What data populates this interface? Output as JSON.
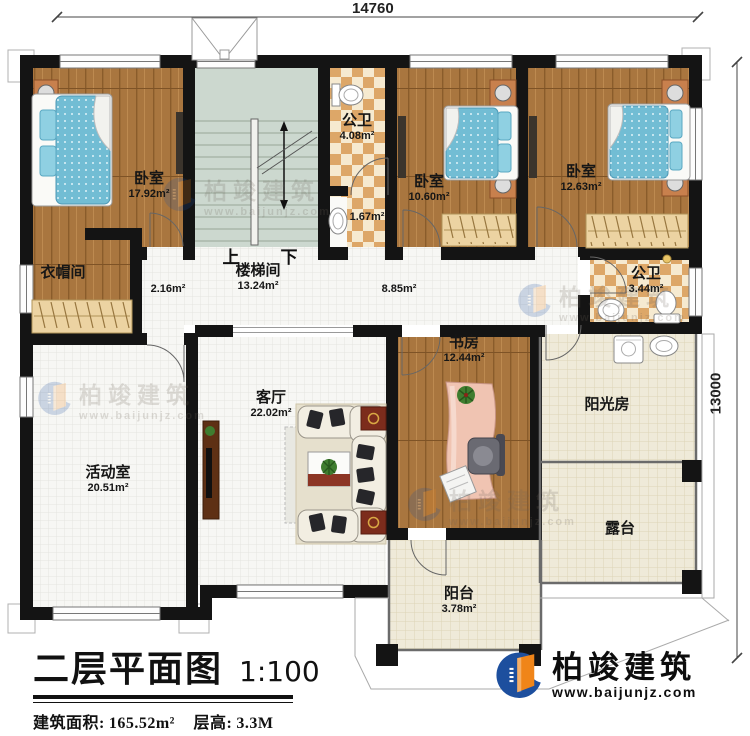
{
  "title": {
    "text": "二层平面图",
    "scale": "1:100",
    "area_label": "建筑面积:",
    "area_value": "165.52m²",
    "floor_label": "层高:",
    "floor_value": "3.3M"
  },
  "dimensions": {
    "width": "14760",
    "height": "13000"
  },
  "stairs": {
    "up": "上",
    "down": "下"
  },
  "rooms": {
    "bedroom1": {
      "name": "卧室",
      "area": "17.92m²"
    },
    "bedroom2": {
      "name": "卧室",
      "area": "10.60m²"
    },
    "bedroom3": {
      "name": "卧室",
      "area": "12.63m²"
    },
    "bath1": {
      "name": "公卫",
      "area": "4.08m²"
    },
    "bath1_sub": {
      "area": "1.67m²"
    },
    "closet": {
      "name": "衣帽间"
    },
    "hall": {
      "area": "2.16m²"
    },
    "stairwell": {
      "name": "楼梯间",
      "area": "13.24m²"
    },
    "corridor": {
      "area": "8.85m²"
    },
    "bath2": {
      "name": "公卫",
      "area": "3.44m²"
    },
    "study": {
      "name": "书房",
      "area": "12.44m²"
    },
    "living": {
      "name": "客厅",
      "area": "22.02m²"
    },
    "activity": {
      "name": "活动室",
      "area": "20.51m²"
    },
    "sunroom": {
      "name": "阳光房"
    },
    "terrace": {
      "name": "露台"
    },
    "balcony": {
      "name": "阳台",
      "area": "3.78m²"
    }
  },
  "brand": {
    "name": "柏竣建筑",
    "url": "www.baijunjz.com"
  },
  "colors": {
    "wall": "#141414",
    "wood": "#a9763f",
    "bath_tile": "#dda768",
    "bed_blue": "#72bdd4",
    "stair_floor": "#ccd8cf",
    "outdoor_tile": "#efead9",
    "logo_blue": "#1d4f9e",
    "logo_orange": "#f08519"
  }
}
